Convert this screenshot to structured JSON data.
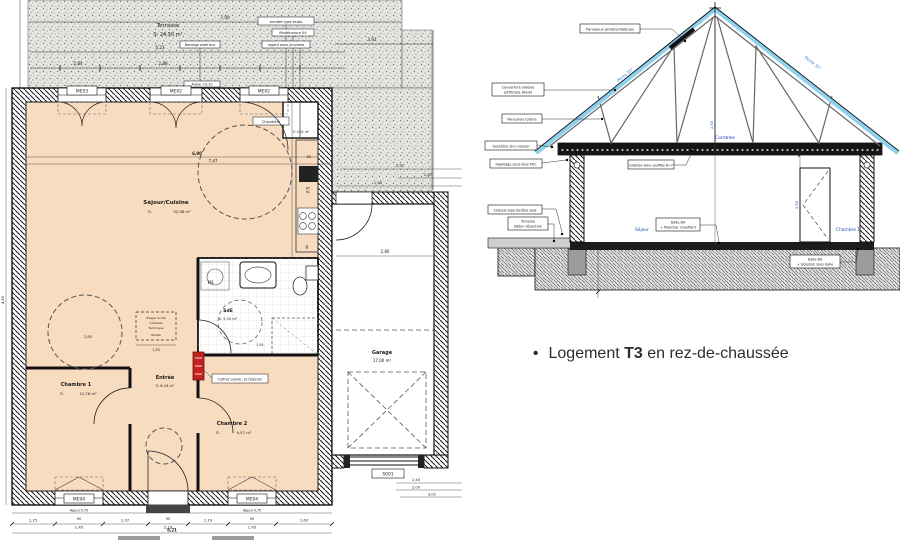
{
  "plan": {
    "terrace": {
      "l1": "Terrasse",
      "l2": "S: 24,50 m²"
    },
    "callouts": {
      "c1": "enrobé type écolo",
      "c2": "Modénature 04",
      "c3": "regard eaux pluviales",
      "c4": "Bardage extérieur",
      "c5": "Arase +0,10",
      "chaudiere": "Chaudière",
      "coffret": "Coffret plomb. et télécom"
    },
    "windows": {
      "me03": "ME03",
      "me02a": "ME02",
      "me02b": "ME02",
      "me04a": "ME04",
      "me04b": "ME04",
      "sg01": "SG01"
    },
    "rooms": {
      "sejour": {
        "n": "Séjour/Cuisine",
        "s": "S:",
        "a": "32,98 m²"
      },
      "ch1": {
        "n": "Chambre 1",
        "s": "S:",
        "a": "12,76 m²"
      },
      "ch2": {
        "n": "Chambre 2",
        "s": "S:",
        "a": "9,57 m²"
      },
      "entree": {
        "n": "Entrée",
        "a": "S: 6,16 m²"
      },
      "sde": {
        "n": "SdE",
        "a": "S: 5,10 m²"
      },
      "garage": {
        "n": "Garage",
        "a": "17,00 m²"
      },
      "placard": {
        "a": "S: 0,51 m²"
      }
    },
    "fixtures": {
      "ml": "ML",
      "r": "R",
      "sv": "S.V"
    },
    "trappe": {
      "l1": "Trappe Accès",
      "l2": "Combles",
      "l3": "Technique",
      "d": "60x60",
      "below": "1,35"
    },
    "dims": {
      "top1": "7,00",
      "top2": "5,21",
      "top3": "2,84",
      "top4": "2,88",
      "right_top": "3,91",
      "in1": "6,90",
      "in2": "7,47",
      "g1": "2,81",
      "g2": "1,87",
      "g3": "1,45",
      "g4": "2,80",
      "b1": "1,25",
      "b2": "90",
      "b3": "1,45",
      "b4": "1,37",
      "b5": "95",
      "b6": "2,19",
      "b7": "1,19",
      "b8": "90",
      "b9": "1,45",
      "b10": "1,63",
      "total": "8,21",
      "appui1": "Appui 0,70",
      "appui2": "Appui 0,70",
      "r1": "2,40",
      "r2": "2,00",
      "r3": "3,02",
      "k60": "60",
      "left1": "4,49",
      "c285": "2,85",
      "s193": "1,93"
    }
  },
  "section": {
    "callouts": {
      "pv": "Panneaux photovoltaïques",
      "cov1": "Couverture ardoise",
      "cov2": "artificielle 60x30",
      "pare": "Pare-pluie toiture",
      "gout": "Gouttière zinc naturel",
      "sousface": "Habillage sous-face PVC",
      "chassis": "Châssis type fenêtre bois",
      "terr1": "Terrasse",
      "terr2": "Béton désactivé",
      "iso": "Isolation laine soufflée R=7",
      "dalle1a": "Dalle BA",
      "dalle1b": "+ Plancher chauffant",
      "dalle2a": "Dalle BA",
      "dalle2b": "+ Isolation sous dalle"
    },
    "labels": {
      "combles": "Combles",
      "sejour": "Séjour",
      "chambre1": "Chambre 1",
      "pente_l": "Pente 35°",
      "pente_r": "Pente 35°",
      "h1": "2,50",
      "h2": "2,50"
    }
  },
  "caption": {
    "bullet": "•",
    "pre": "Logement ",
    "bold": "T3",
    "post": " en rez-de-chaussée"
  }
}
